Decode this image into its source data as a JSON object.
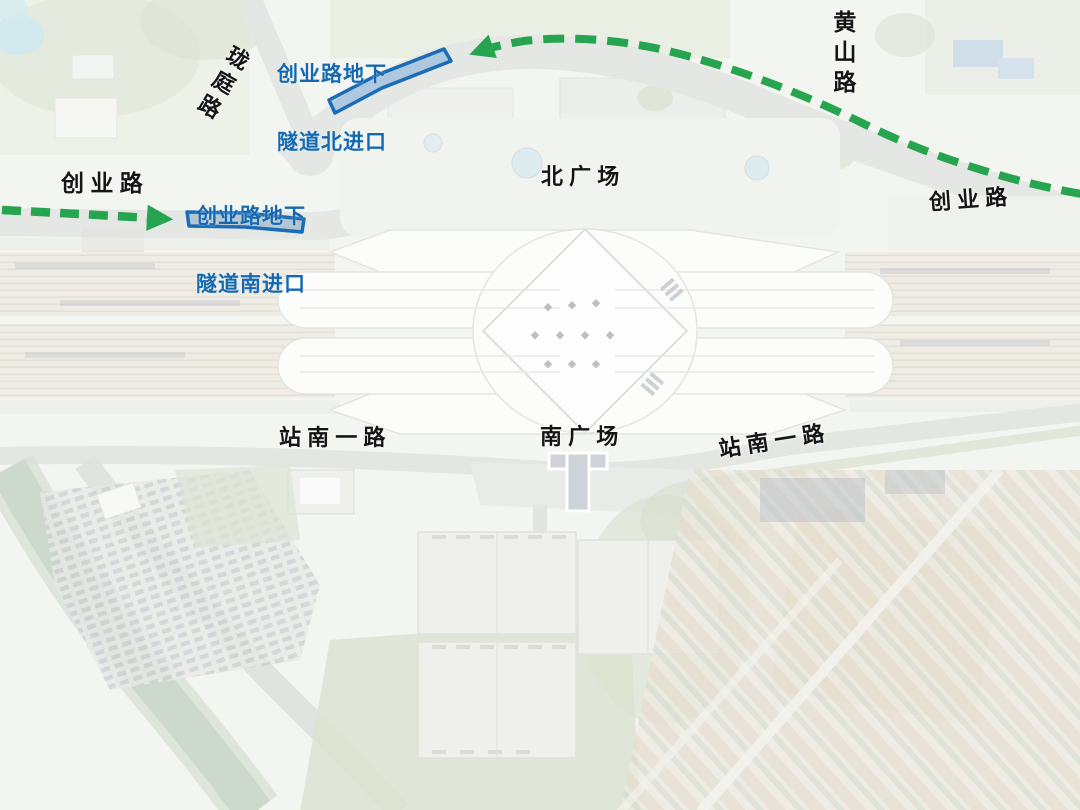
{
  "map": {
    "labels": {
      "north_tunnel_entrance": {
        "line1": "创业路地下",
        "line2": "隧道北进口"
      },
      "south_tunnel_entrance": {
        "line1": "创业路地下",
        "line2": "隧道南进口"
      },
      "longting_road": "珑庭路",
      "huangshan_road": "黄山路",
      "chuangye_road_west": "创 业 路",
      "chuangye_road_east": "创 业 路",
      "north_square": "北 广 场",
      "south_square": "南 广 场",
      "station_south_road_west": "站 南 一 路",
      "station_south_road_east": "站 南 一 路"
    },
    "colors": {
      "route_green": "#27a44f",
      "label_blue": "#1569b0",
      "tunnel_shape_stroke": "#1b6cb6",
      "road_label_black": "#151515"
    }
  }
}
